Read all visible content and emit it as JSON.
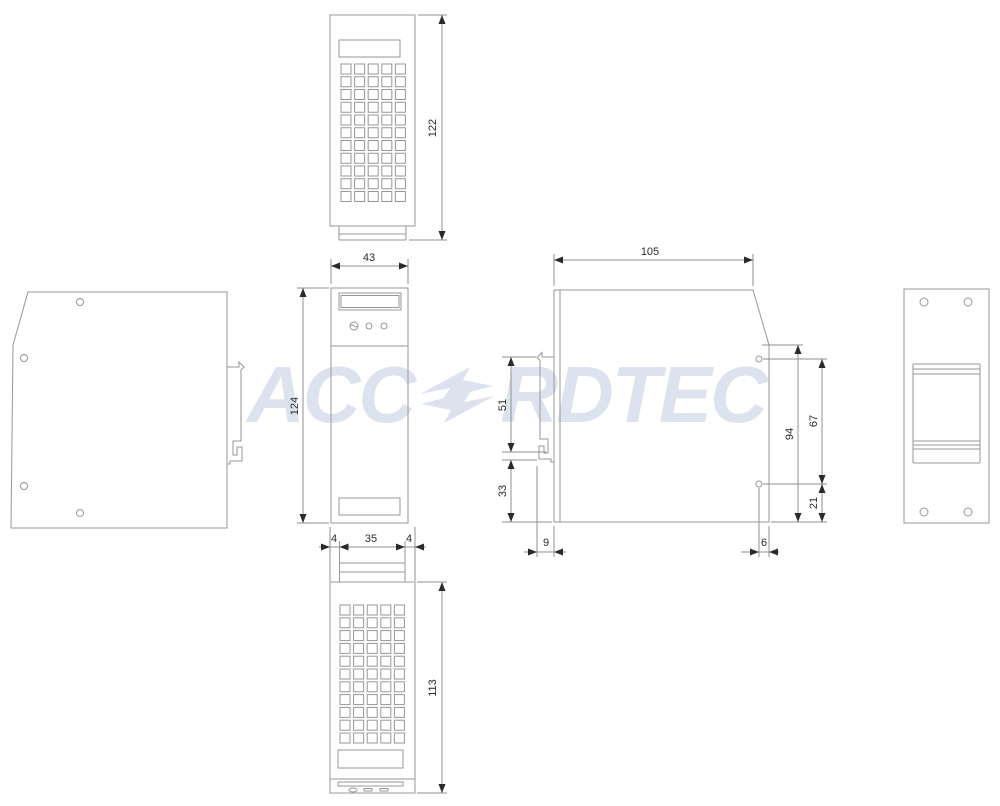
{
  "watermark": {
    "prefix": "ACC",
    "suffix": "RDTEC"
  },
  "views": {
    "top": {
      "dim_height": "122"
    },
    "front": {
      "dim_width": "43",
      "dim_height": "124",
      "dim_foot_left": "4",
      "dim_foot_width": "35",
      "dim_foot_right": "4"
    },
    "side": {
      "dim_depth": "105",
      "dim_clip_len": "51",
      "dim_clip_bottom": "33",
      "dim_clip_protrusion": "9",
      "dim_back_height": "94",
      "dim_hole_span": "67",
      "dim_hole_bottom": "21",
      "dim_hole_edge": "6"
    },
    "bottom": {
      "dim_height": "113"
    }
  },
  "vent_grid": {
    "cols": 5,
    "rows": 11
  },
  "colors": {
    "outline": "#979797",
    "dimension": "#8f8f8f",
    "ink": "#2a2a2a",
    "watermark": "#dce3ee",
    "background": "#ffffff"
  }
}
